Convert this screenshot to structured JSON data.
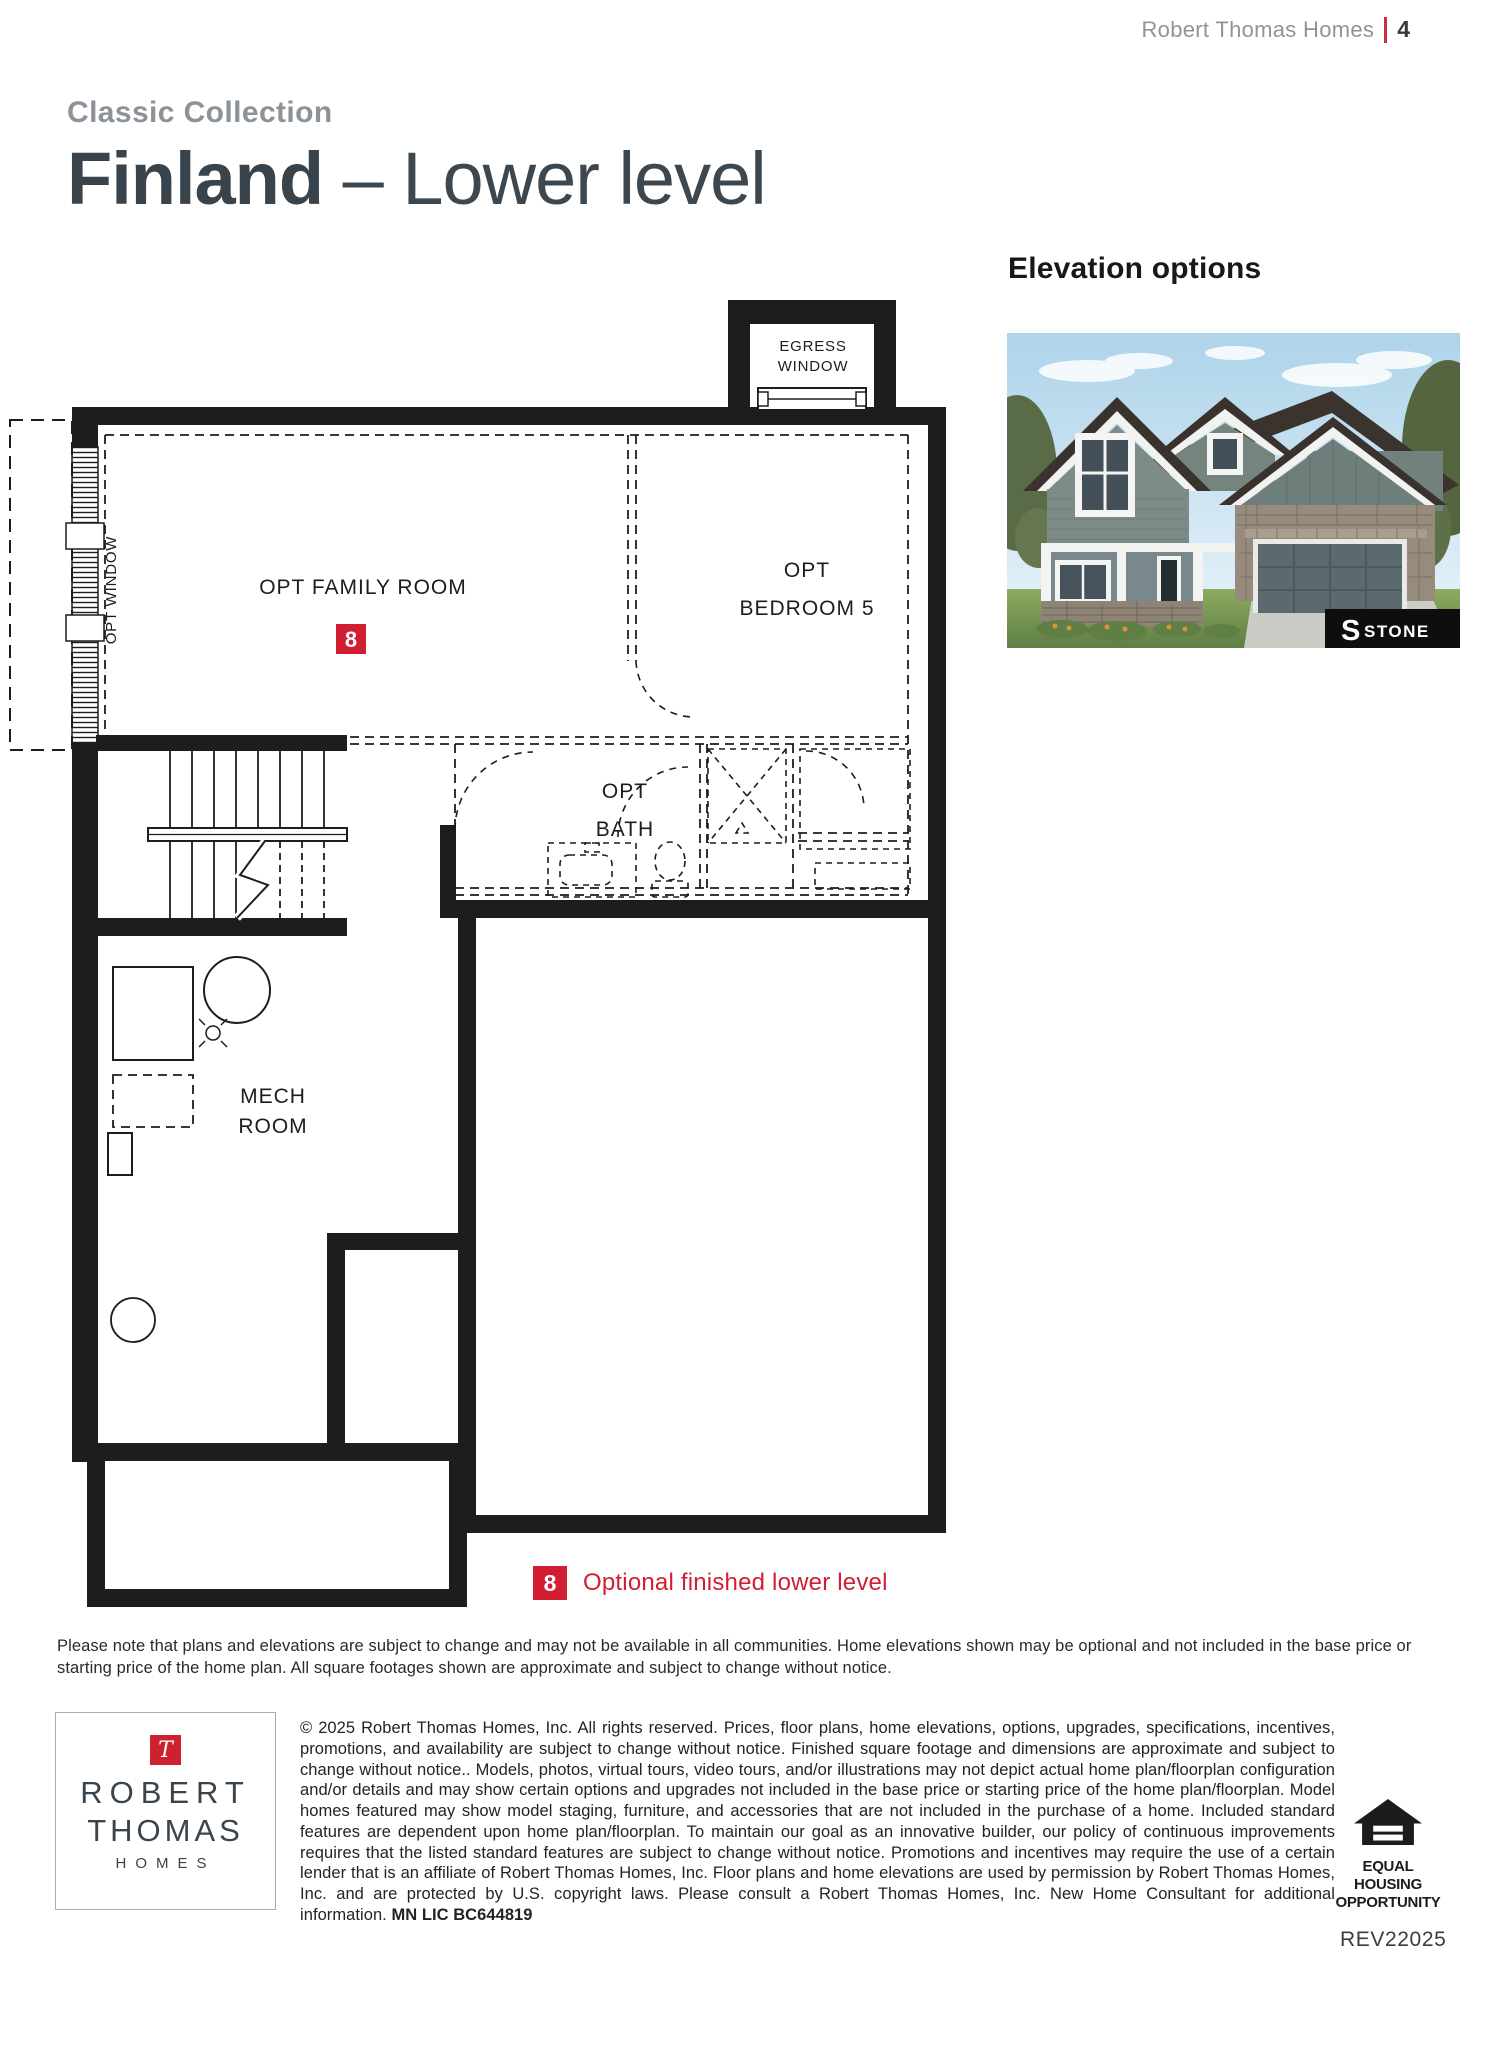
{
  "header": {
    "brand": "Robert Thomas Homes",
    "page_number": "4"
  },
  "title": {
    "collection": "Classic Collection",
    "plan_name": "Finland",
    "separator": "–",
    "level": "Lower level"
  },
  "elevation": {
    "heading": "Elevation options",
    "badge_prefix": "S",
    "badge_label": "STONE"
  },
  "floorplan": {
    "labels": {
      "egress_line1": "EGRESS",
      "egress_line2": "WINDOW",
      "opt_window": "OPT WINDOW",
      "opt_family_room": "OPT FAMILY ROOM",
      "opt_bedroom_line1": "OPT",
      "opt_bedroom_line2": "BEDROOM 5",
      "opt_bath_line1": "OPT",
      "opt_bath_line2": "BATH",
      "mech_line1": "MECH",
      "mech_line2": "ROOM",
      "option_badge": "8"
    }
  },
  "legend": {
    "badge": "8",
    "label": "Optional finished lower level"
  },
  "disclaimer": "Please note that plans and elevations are subject to change and may not be available in all communities. Home elevations shown may be optional and not included in the base price or starting price of the home plan. All square footages shown are approximate and subject to change without notice.",
  "footer": {
    "logo": {
      "initial": "T",
      "line1": "ROBERT",
      "line2": "THOMAS",
      "line3": "HOMES"
    },
    "copyright": "© 2025 Robert Thomas Homes, Inc. All rights reserved. Prices, floor plans, home elevations, options, upgrades, specifications, incentives, promotions, and availability are subject to change without notice. Finished square footage and dimensions are approximate and subject to change without notice.. Models, photos, virtual tours, video tours, and/or illustrations may not depict actual home plan/floorplan configuration and/or details and may show certain options and upgrades not included in the base price or starting price of the home plan/floorplan. Model homes featured may show model staging, furniture, and accessories that are not included in the purchase of a home. Included standard features are dependent upon home plan/floorplan. To maintain our goal as an innovative builder, our policy of continuous improvements requires that the listed standard features are subject to change without notice. Promotions and incentives may require the use of a certain lender that is an affiliate of Robert Thomas Homes, Inc. Floor plans and home elevations are used by permission by Robert Thomas Homes, Inc. and are protected by U.S. copyright laws. Please consult a Robert Thomas Homes, Inc. New Home Consultant for additional information. ",
    "license": "MN LIC BC644819",
    "equal_housing": {
      "line1": "EQUAL HOUSING",
      "line2": "OPPORTUNITY"
    },
    "revision": "REV22025"
  },
  "colors": {
    "accent_red": "#d21e32",
    "title_dark": "#39434b",
    "gray": "#8b9298",
    "line": "#1d1d1b"
  }
}
